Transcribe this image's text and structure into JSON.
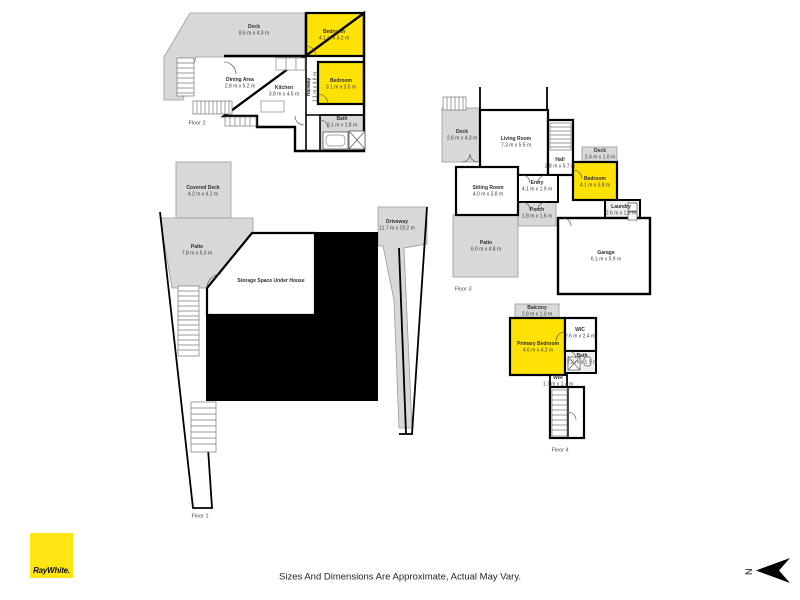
{
  "branding": {
    "logo_text": "RayWhite.",
    "brand_yellow": "#FFE512"
  },
  "footer": {
    "disclaimer": "Sizes And Dimensions Are Approximate, Actual May Vary."
  },
  "compass": {
    "label": "N"
  },
  "colors": {
    "highlight_room_yellow": "#FFE205",
    "outdoor_gray": "#D8D8D8",
    "wall_black": "#000000",
    "under_house_black": "#000000"
  },
  "floors": [
    {
      "label": "Floor 2",
      "rooms": [
        {
          "name": "Deck",
          "dims": "8.6 m x 4.3 m"
        },
        {
          "name": "Bedroom",
          "dims": "4.1 m x 3.2 m"
        },
        {
          "name": "Bedroom",
          "dims": "3.1 m x 3.5 m"
        },
        {
          "name": "Dining Area",
          "dims": "2.8 m x 5.2 m"
        },
        {
          "name": "Kitchen",
          "dims": "3.8 m x 4.5 m"
        },
        {
          "name": "Hallway",
          "dims": "1.1 m x 4.6 m"
        },
        {
          "name": "Bath",
          "dims": "3.1 m x 1.8 m"
        }
      ]
    },
    {
      "label": "Floor 1",
      "rooms": [
        {
          "name": "Covered Deck",
          "dims": "4.2 m x 4.1 m"
        },
        {
          "name": "Patio",
          "dims": "7.8 m x 5.3 m"
        },
        {
          "name": "Storage Space Under House",
          "dims": ""
        },
        {
          "name": "Driveway",
          "dims": "11.7 m x 19.2 m"
        }
      ]
    },
    {
      "label": "Floor 3",
      "rooms": [
        {
          "name": "Deck",
          "dims": "2.8 m x 4.3 m"
        },
        {
          "name": "Living Room",
          "dims": "7.3 m x 5.5 m"
        },
        {
          "name": "Hall",
          "dims": "2.8 m x 5.7 m"
        },
        {
          "name": "Deck",
          "dims": "2.4 m x 1.0 m"
        },
        {
          "name": "Bedroom",
          "dims": "4.1 m x 3.8 m"
        },
        {
          "name": "Sitting Room",
          "dims": "4.0 m x 3.8 m"
        },
        {
          "name": "Entry",
          "dims": "4.1 m x 1.9 m"
        },
        {
          "name": "Porch",
          "dims": "1.8 m x 1.6 m"
        },
        {
          "name": "Patio",
          "dims": "6.0 m x 4.8 m"
        },
        {
          "name": "Laundry",
          "dims": "2.6 m x 1.6 m"
        },
        {
          "name": "Garage",
          "dims": "6.1 m x 5.9 m"
        }
      ]
    },
    {
      "label": "Floor 4",
      "rooms": [
        {
          "name": "Balcony",
          "dims": "2.8 m x 1.0 m"
        },
        {
          "name": "Primary Bedroom",
          "dims": "4.6 m x 4.2 m"
        },
        {
          "name": "WIC",
          "dims": "2.6 m x 2.4 m"
        },
        {
          "name": "Bath",
          "dims": "2.2 m x 1.9 m"
        },
        {
          "name": "WIR",
          "dims": "1.7 m x 1.4 m"
        }
      ]
    }
  ]
}
